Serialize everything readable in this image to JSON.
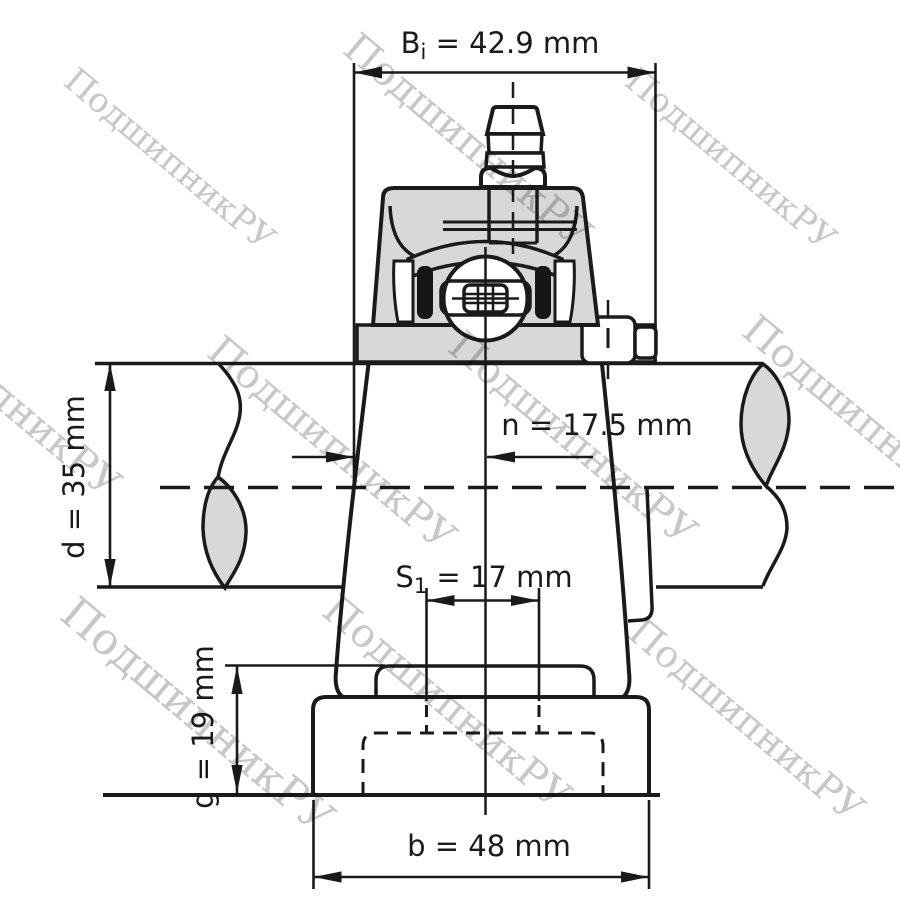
{
  "watermark": {
    "text": "ПодшипникРУ"
  },
  "dimensions": {
    "bi": {
      "prefix": "B",
      "sub": "i",
      "rest": " = 42.9 mm",
      "value": 42.9,
      "unit": "mm"
    },
    "d": {
      "text": "d = 35 mm",
      "value": 35,
      "unit": "mm"
    },
    "n": {
      "text": "n = 17.5 mm",
      "value": 17.5,
      "unit": "mm"
    },
    "s1": {
      "prefix": "S",
      "sub": "1",
      "rest": " = 17 mm",
      "value": 17,
      "unit": "mm"
    },
    "g": {
      "text": "g = 19 mm",
      "value": 19,
      "unit": "mm"
    },
    "b": {
      "text": "b = 48 mm",
      "value": 48,
      "unit": "mm"
    }
  },
  "colors": {
    "line": "#1a1a1a",
    "housing_fill": "#d8d8d8",
    "watermark": "#c7c7c7",
    "background": "#ffffff"
  }
}
